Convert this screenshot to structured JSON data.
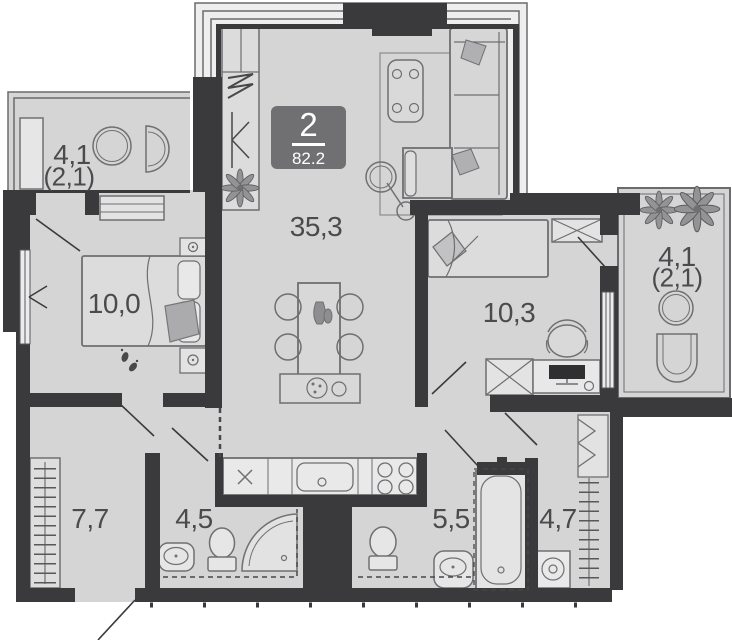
{
  "floorplan": {
    "badge": {
      "rooms_count": "2",
      "total_area": "82.2"
    },
    "rooms": [
      {
        "id": "living-kitchen",
        "area": "35,3"
      },
      {
        "id": "bedroom-left",
        "area": "10,0"
      },
      {
        "id": "bedroom-right",
        "area": "10,3"
      },
      {
        "id": "balcony-left",
        "area": "4,1",
        "reduced_area": "(2,1)"
      },
      {
        "id": "balcony-right",
        "area": "4,1",
        "reduced_area": "(2,1)"
      },
      {
        "id": "hallway",
        "area": "7,7"
      },
      {
        "id": "bathroom",
        "area": "4,5"
      },
      {
        "id": "bathroom-2",
        "area": "5,5"
      },
      {
        "id": "laundry",
        "area": "4,7"
      }
    ],
    "colors": {
      "wall": "#3a3a3c",
      "floor": "#d5d5d6",
      "window_band": "#eeeeee",
      "furniture_outline": "#707072",
      "badge_bg": "#707072",
      "label_text": "#4b4b4d"
    }
  }
}
